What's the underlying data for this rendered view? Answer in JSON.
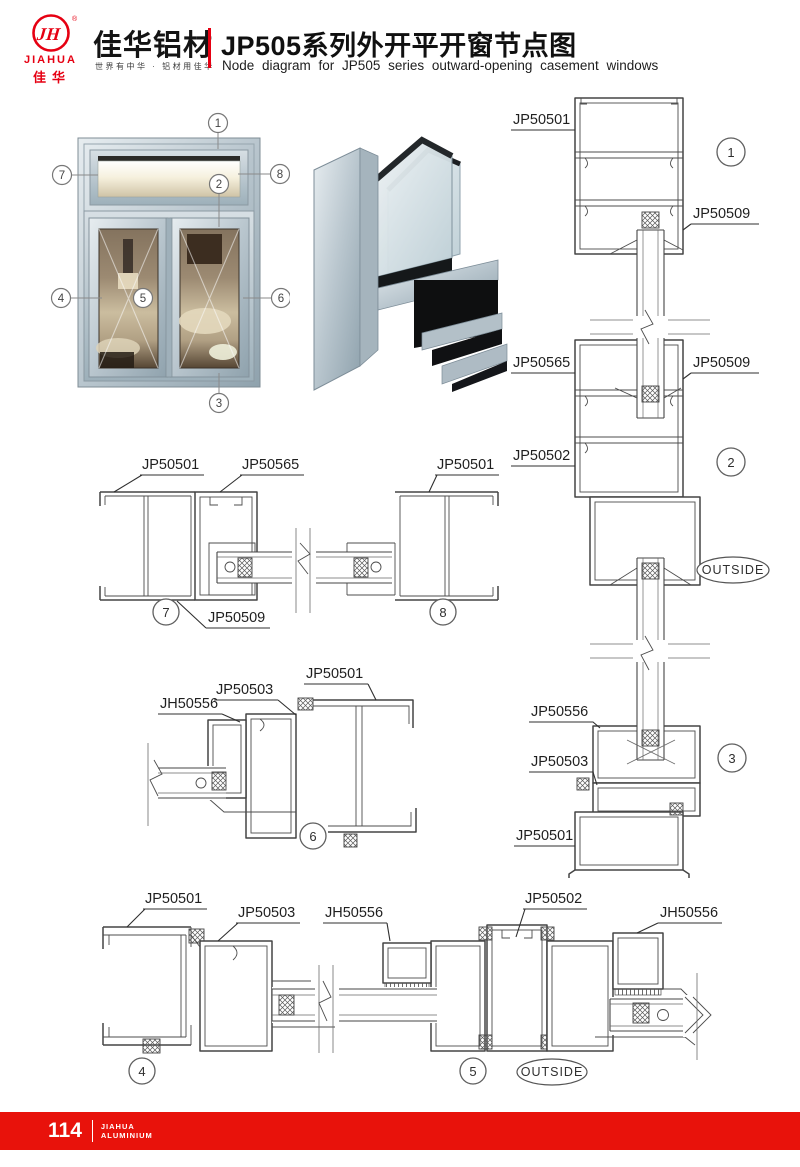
{
  "header": {
    "logo_monogram": "JH",
    "logo_registered": "®",
    "logo_brand_en": "JIAHUA",
    "logo_brand_cn": "佳华",
    "company_name": "佳华铝材",
    "slogan": "世界有中华 · 铝材用佳华",
    "title_cn": "JP505系列外开平开窗节点图",
    "title_en": "Node diagram for JP505 series outward-opening casement windows"
  },
  "colors": {
    "brand_red": "#e60012",
    "line": "#454545",
    "aluminium": "#b6c3cb"
  },
  "overview": {
    "callouts": [
      "1",
      "2",
      "3",
      "4",
      "5",
      "6",
      "7",
      "8"
    ]
  },
  "diagrams": {
    "vertical": {
      "labels": [
        "JP50501",
        "JP50509",
        "JP50565",
        "JP50509",
        "JP50502",
        "JP50556",
        "JP50503",
        "JP50501"
      ],
      "callouts": [
        "1",
        "2",
        "3"
      ],
      "outside": "OUTSIDE"
    },
    "horizontal_top": {
      "labels": [
        "JP50501",
        "JP50565",
        "JP50501",
        "JP50509"
      ],
      "callouts": [
        "7",
        "8"
      ]
    },
    "corner": {
      "labels": [
        "JP50501",
        "JP50503",
        "JH50556"
      ],
      "callouts": [
        "6"
      ]
    },
    "horizontal_bottom": {
      "labels": [
        "JP50501",
        "JP50503",
        "JH50556",
        "JP50502",
        "JH50556"
      ],
      "callouts": [
        "4",
        "5"
      ],
      "outside": "OUTSIDE"
    }
  },
  "footer": {
    "page_number": "114",
    "brand_top": "JIAHUA",
    "brand_bottom": "ALUMINIUM"
  }
}
